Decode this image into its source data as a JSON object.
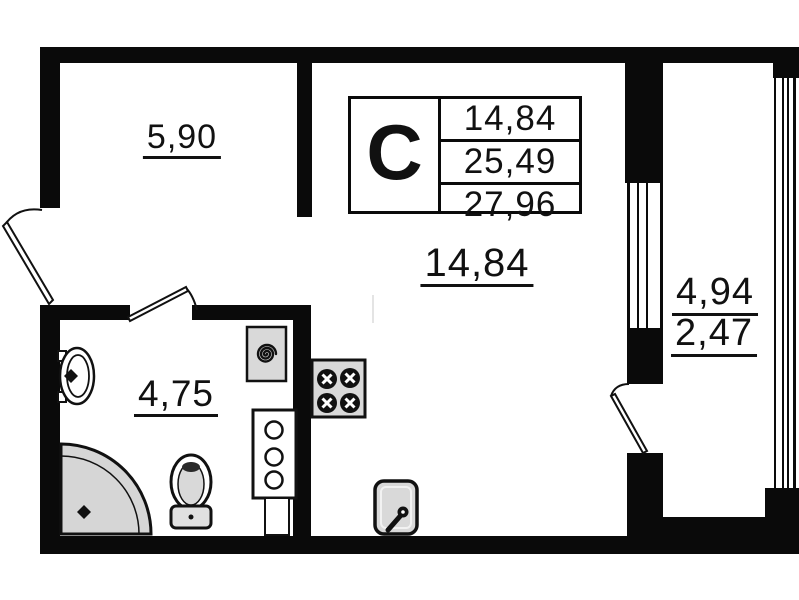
{
  "plan": {
    "title_block": {
      "type_letter": "С",
      "values": [
        "14,84",
        "25,49",
        "27,96"
      ]
    },
    "rooms": {
      "hallway": {
        "area": "5,90"
      },
      "living": {
        "area": "14,84"
      },
      "bathroom": {
        "area": "4,75"
      },
      "balcony": {
        "area_full": "4,94",
        "area_reduced": "2,47"
      }
    },
    "colors": {
      "wall": "#0a0a0a",
      "fixture_fill": "#d9d9d9",
      "background": "#ffffff"
    }
  }
}
